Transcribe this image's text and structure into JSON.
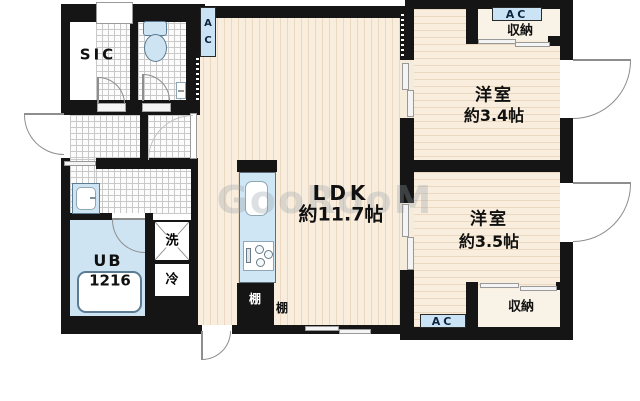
{
  "watermark": "GooRooM",
  "labels": {
    "sic": "SIC",
    "ac_a": "A",
    "ac_c": "C",
    "ac_closet_top": "AC",
    "ac_bottom": "AC",
    "closet_top": "収納",
    "closet_bottom": "収納",
    "bedroom1_name": "洋室",
    "bedroom1_size": "約3.4帖",
    "bedroom2_name": "洋室",
    "bedroom2_size": "約3.5帖",
    "ldk_name": "LDK",
    "ldk_size": "約11.7帖",
    "bath_name": "UB",
    "bath_size": "1216",
    "washer": "洗",
    "fridge": "冷",
    "shelf_kitchen": "棚",
    "shelf_ldk": "棚"
  },
  "colors": {
    "wall": "#151515",
    "floor_wood": "#f9eedd",
    "floor_stripe": "#ead9c0",
    "tile_line": "#c9c9c9",
    "fixture_fill": "#cfe4f2",
    "fixture_border": "#5b7c92",
    "ac_label_bg": "#cae4f5",
    "door_arc": "#8e8e8e"
  }
}
